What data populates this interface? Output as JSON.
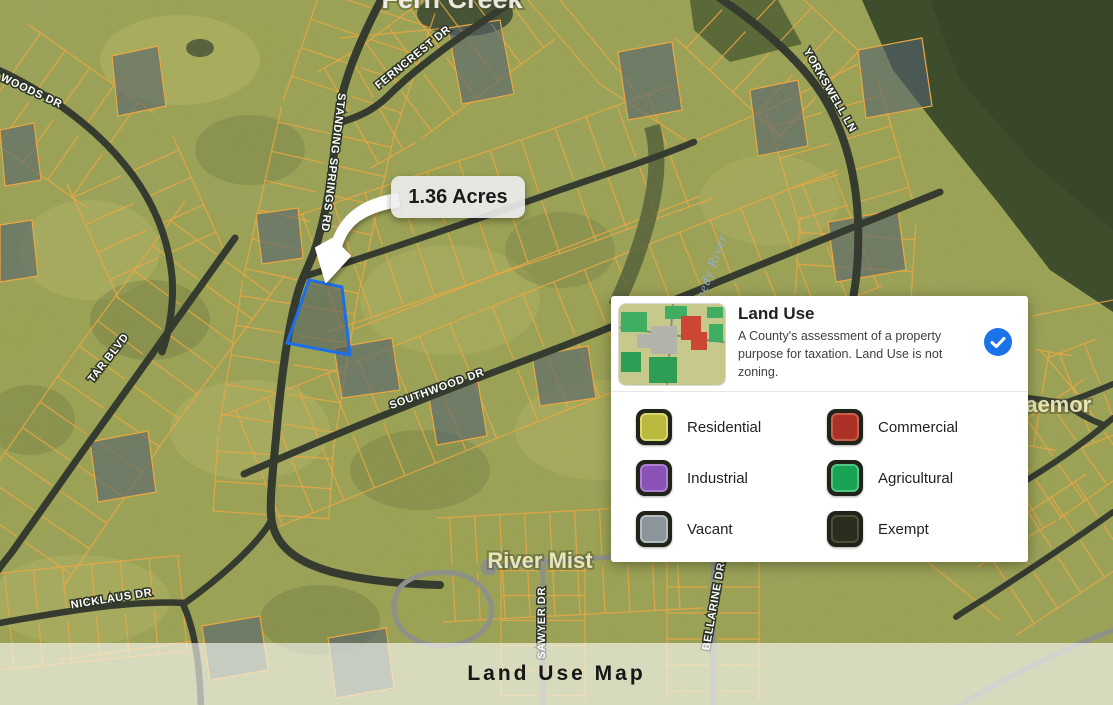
{
  "map": {
    "street_labels": [
      {
        "text": "WOODS DR"
      },
      {
        "text": "FERNCREST DR"
      },
      {
        "text": "STANDING SPRINGS RD"
      },
      {
        "text": "TAR BLVD"
      },
      {
        "text": "YORKSWELL LN"
      },
      {
        "text": "SOUTHWOOD DR"
      },
      {
        "text": "NICKLAUS DR"
      },
      {
        "text": "SAWYER DR"
      },
      {
        "text": "BELLARINE DR"
      }
    ],
    "place_labels": [
      {
        "text": "Fern Creek"
      },
      {
        "text": "River Mist"
      },
      {
        "text": "Braemor"
      }
    ],
    "water_labels": [
      {
        "text": "Reedy River"
      }
    ],
    "selected_parcel": {
      "area_label": "1.36 Acres",
      "outline_color": "#1c6fe8"
    }
  },
  "legend": {
    "title": "Land Use",
    "description": "A County's assessment of a property purpose for taxation. Land Use is not zoning.",
    "toggle_color": "#1a73e8",
    "items": [
      {
        "label": "Residential",
        "color": "#b9b93f",
        "border_color": "#dcd96b"
      },
      {
        "label": "Commercial",
        "color": "#ac3226",
        "border_color": "#c95f4b"
      },
      {
        "label": "Industrial",
        "color": "#8a52b5",
        "border_color": "#ab7fd2"
      },
      {
        "label": "Agricultural",
        "color": "#18a355",
        "border_color": "#52c584"
      },
      {
        "label": "Vacant",
        "color": "#8b959b",
        "border_color": "#b1bbc0"
      },
      {
        "label": "Exempt",
        "color": "#2a2e1f",
        "border_color": "#4b5038"
      }
    ]
  },
  "footer": {
    "title": "Land Use Map"
  }
}
